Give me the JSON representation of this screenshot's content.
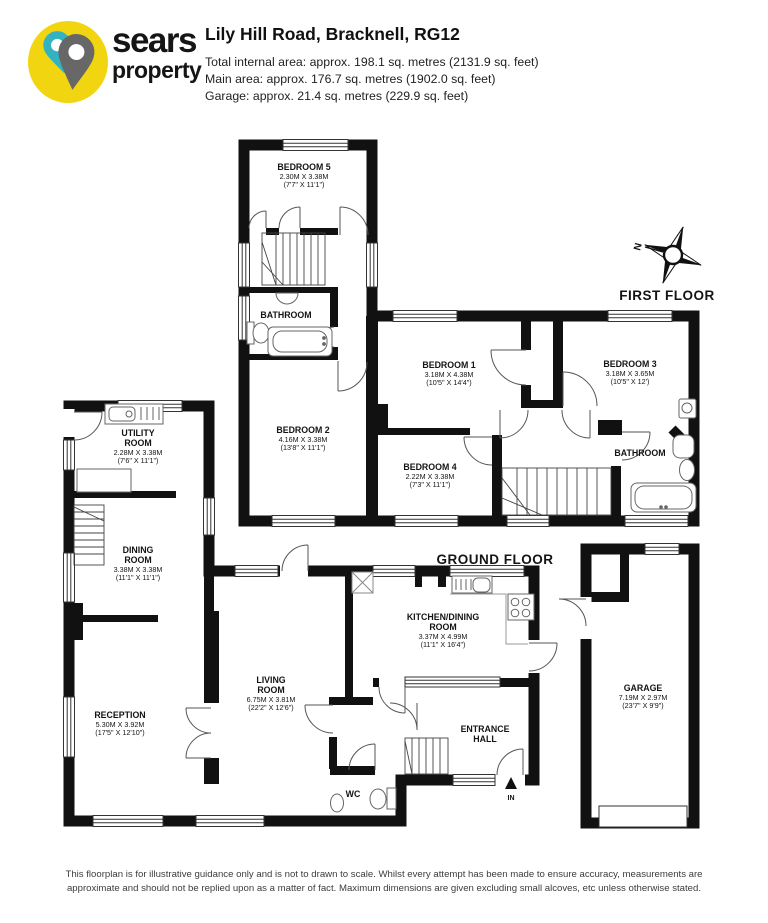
{
  "header": {
    "brand_line1": "sears",
    "brand_line2": "property",
    "title": "Lily Hill Road, Bracknell, RG12",
    "area_total": "Total internal area: approx. 198.1 sq. metres (2131.9 sq. feet)",
    "area_main": "Main area: approx. 176.7 sq. metres (1902.0 sq. feet)",
    "area_garage": "Garage: approx. 21.4 sq. metres (229.9 sq. feet)"
  },
  "plan": {
    "first_floor_label": "FIRST FLOOR",
    "ground_floor_label": "GROUND FLOOR",
    "compass_north": "N",
    "entrance_in": "IN"
  },
  "rooms": {
    "bedroom5": {
      "name": "BEDROOM 5",
      "metric": "2.30M X 3.38M",
      "imperial": "(7'7\" X 11'1\")"
    },
    "bathroom_first_left": {
      "name": "BATHROOM"
    },
    "bedroom2": {
      "name": "BEDROOM 2",
      "metric": "4.16M X 3.38M",
      "imperial": "(13'8\" X 11'1\")"
    },
    "bedroom1": {
      "name": "BEDROOM 1",
      "metric": "3.18M X 4.38M",
      "imperial": "(10'5\" X 14'4\")"
    },
    "bedroom3": {
      "name": "BEDROOM 3",
      "metric": "3.18M X 3.65M",
      "imperial": "(10'5\" X 12')"
    },
    "bedroom4": {
      "name": "BEDROOM 4",
      "metric": "2.22M X 3.38M",
      "imperial": "(7'3\" X 11'1\")"
    },
    "bathroom_first_right": {
      "name": "BATHROOM"
    },
    "utility": {
      "name_line1": "UTILITY",
      "name_line2": "ROOM",
      "metric": "2.28M X 3.38M",
      "imperial": "(7'6\" X 11'1\")"
    },
    "dining": {
      "name_line1": "DINING",
      "name_line2": "ROOM",
      "metric": "3.38M X 3.38M",
      "imperial": "(11'1\" X 11'1\")"
    },
    "reception": {
      "name": "RECEPTION",
      "metric": "5.30M X 3.92M",
      "imperial": "(17'5\" X 12'10\")"
    },
    "living": {
      "name_line1": "LIVING",
      "name_line2": "ROOM",
      "metric": "6.75M X 3.81M",
      "imperial": "(22'2\" X 12'6\")"
    },
    "kitchen": {
      "name_line1": "KITCHEN/DINING",
      "name_line2": "ROOM",
      "metric": "3.37M X 4.99M",
      "imperial": "(11'1\" X 16'4\")"
    },
    "entrance": {
      "name_line1": "ENTRANCE",
      "name_line2": "HALL"
    },
    "wc": {
      "name": "WC"
    },
    "garage": {
      "name": "GARAGE",
      "metric": "7.19M X 2.97M",
      "imperial": "(23'7\" X 9'9\")"
    }
  },
  "footer": {
    "line1": "This floorplan is for illustrative guidance only and is not to drawn to scale. Whilst every attempt has been made to ensure accuracy, measurements are",
    "line2": "approximate and should not be replied upon as a matter of fact. Maximum dimensions are given excluding small alcoves, etc unless otherwise stated."
  },
  "colors": {
    "wall": "#111111",
    "brand_yellow": "#f2d511",
    "brand_teal": "#33b3c2",
    "brand_gray": "#676767"
  }
}
